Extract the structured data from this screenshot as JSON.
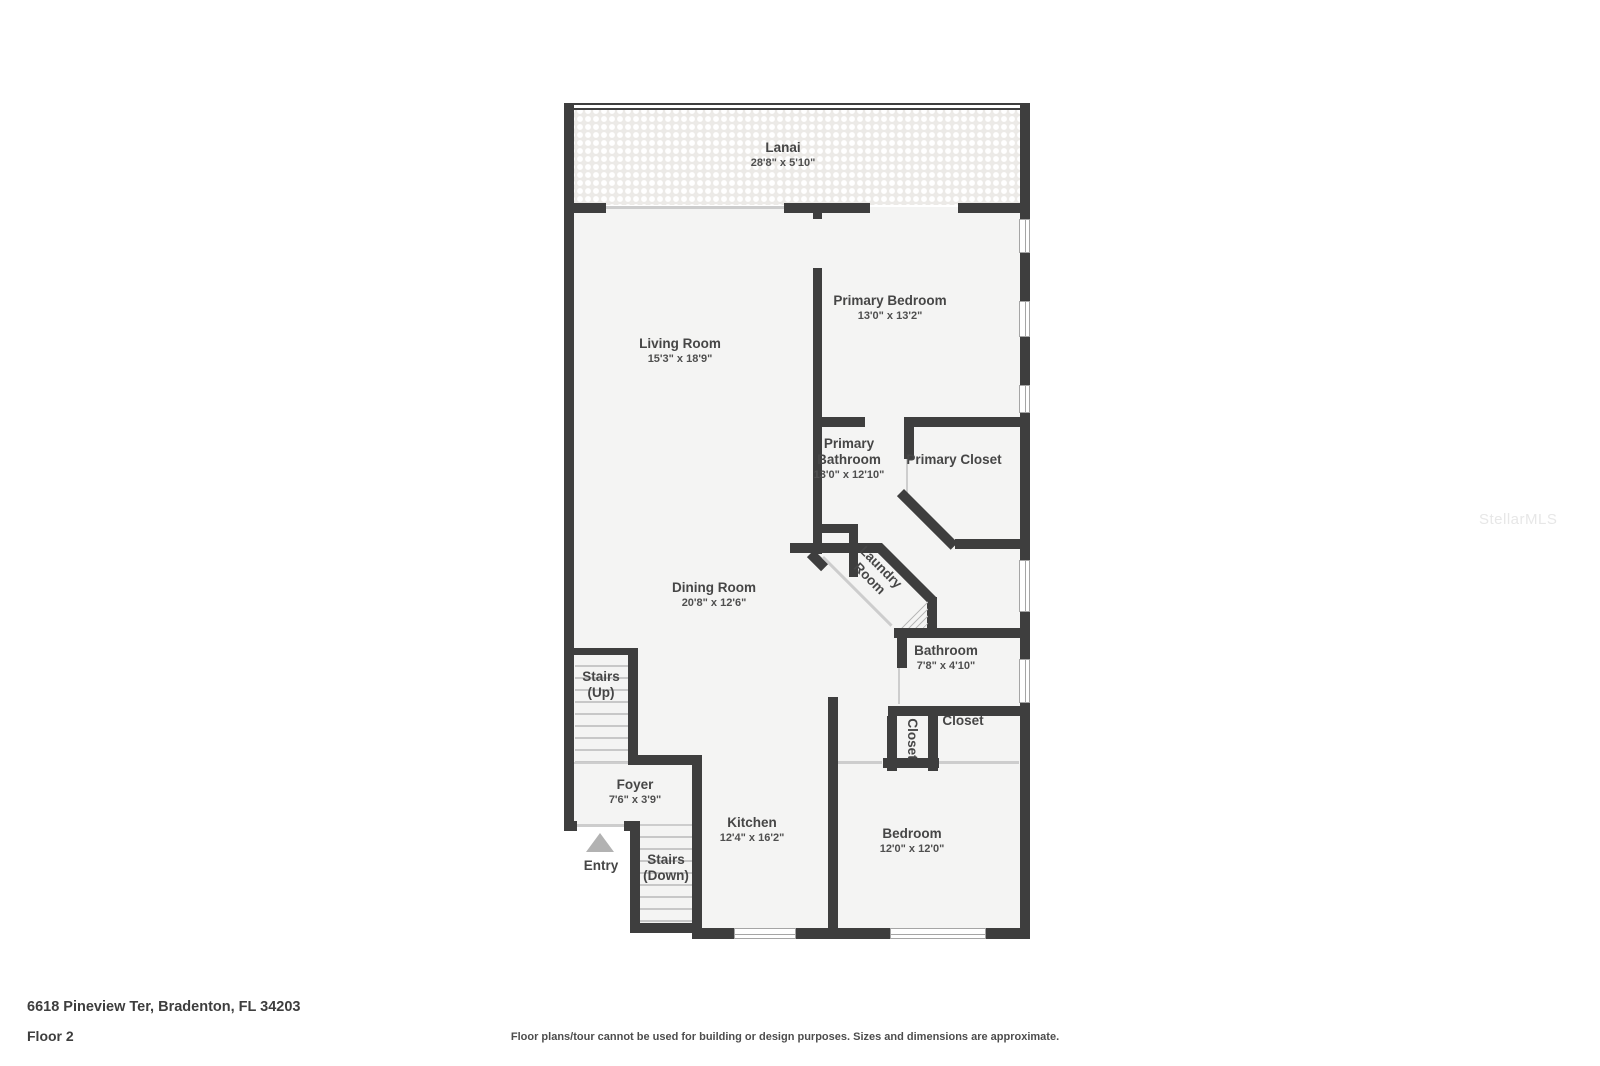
{
  "plan": {
    "rooms": {
      "lanai": {
        "name": "Lanai",
        "dims": "28'8\" x 5'10\""
      },
      "living_room": {
        "name": "Living Room",
        "dims": "15'3\" x 18'9\""
      },
      "primary_bedroom": {
        "name": "Primary Bedroom",
        "dims": "13'0\" x 13'2\""
      },
      "primary_bathroom": {
        "name": "Primary Bathroom",
        "dims": "13'0\" x 12'10\""
      },
      "primary_closet": {
        "name": "Primary Closet"
      },
      "laundry_room": {
        "name": "Laundry Room"
      },
      "dining_room": {
        "name": "Dining Room",
        "dims": "20'8\" x 12'6\""
      },
      "bathroom": {
        "name": "Bathroom",
        "dims": "7'8\" x 4'10\""
      },
      "stairs_up": {
        "name": "Stairs (Up)"
      },
      "closet_hall": {
        "name": "Closet"
      },
      "closet_bedroom": {
        "name": "Closet"
      },
      "foyer": {
        "name": "Foyer",
        "dims": "7'6\" x 3'9\""
      },
      "kitchen": {
        "name": "Kitchen",
        "dims": "12'4\" x 16'2\""
      },
      "bedroom": {
        "name": "Bedroom",
        "dims": "12'0\" x 12'0\""
      },
      "entry": {
        "name": "Entry"
      },
      "stairs_down": {
        "name": "Stairs (Down)"
      }
    }
  },
  "footer": {
    "address": "6618 Pineview Ter, Bradenton, FL 34203",
    "floor": "Floor 2",
    "disclaimer": "Floor plans/tour cannot be used for building or design purposes. Sizes and dimensions are approximate."
  },
  "watermark": "StellarMLS",
  "colors": {
    "wall": "#3e3e3e",
    "room_fill": "#f4f4f3",
    "lanai_texture": "#eceae7",
    "label_text": "#464646"
  }
}
